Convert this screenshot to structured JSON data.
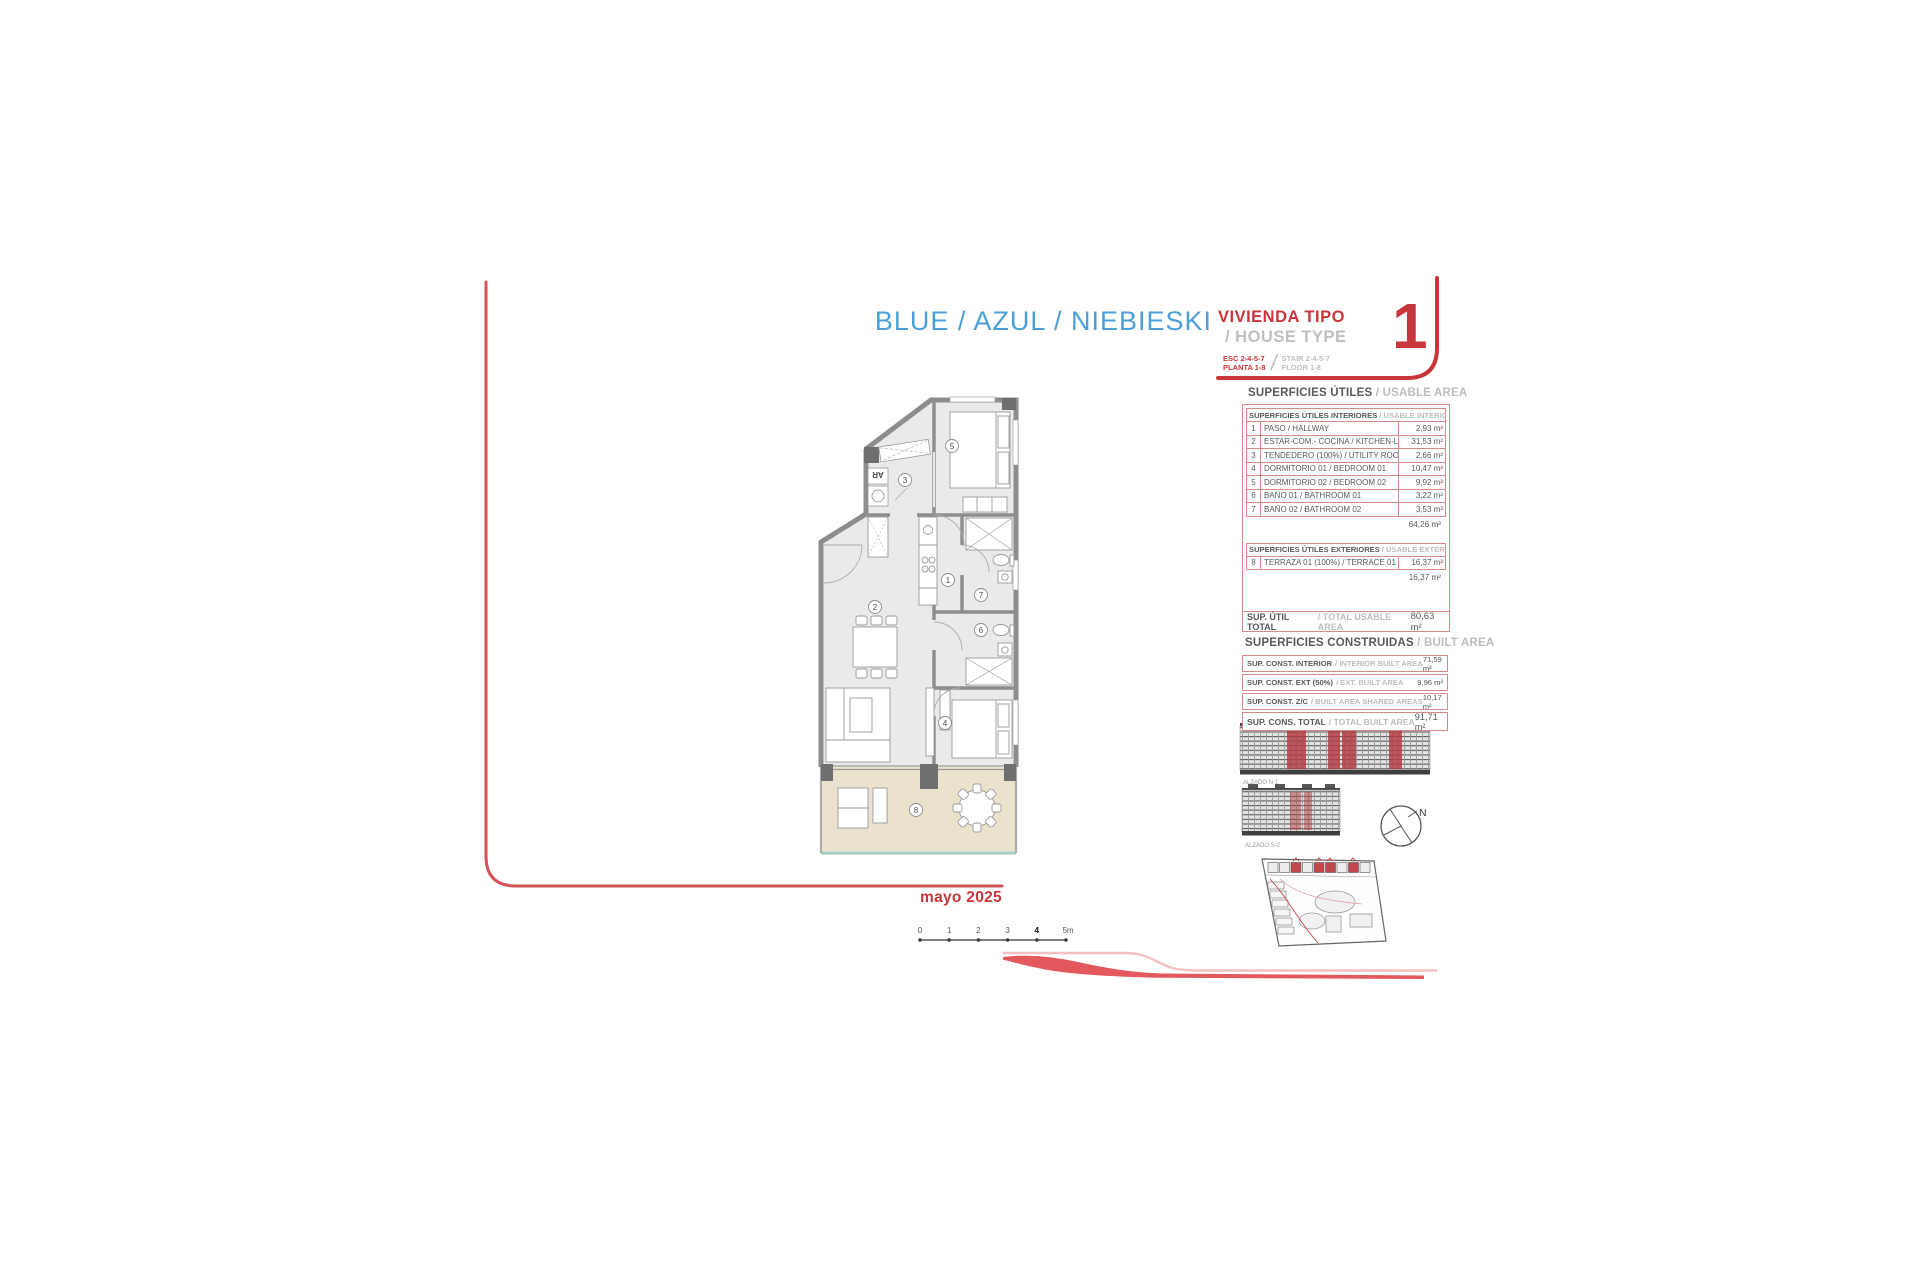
{
  "title": {
    "names": "BLUE / AZUL / NIEBIESKI",
    "vivienda": "VIVIENDA TIPO",
    "house_type": "/ HOUSE TYPE",
    "esc": "ESC 2-4-5-7",
    "planta": "PLANTA 1-8",
    "stair": "STAIR 2-4-5-7",
    "floor": "FLOOR 1-8",
    "number": "1"
  },
  "usable": {
    "heading_es": "SUPERFICIES ÚTILES",
    "heading_en": "/ USABLE AREA",
    "interior": {
      "header_es": "SUPERFICIES ÚTILES INTERIORES",
      "header_en": "/ USABLE INTERIOR AREA",
      "rows": [
        {
          "num": "1",
          "label": "PASO / HALLWAY",
          "value": "2,93 m²"
        },
        {
          "num": "2",
          "label": "ESTAR-COM.- COCINA / KITCHEN-LIVING",
          "value": "31,53 m²"
        },
        {
          "num": "3",
          "label": "TENDEDERO (100%) / UTILITY ROOM",
          "value": "2,66 m²"
        },
        {
          "num": "4",
          "label": "DORMITORIO 01 / BEDROOM 01",
          "value": "10,47 m²"
        },
        {
          "num": "5",
          "label": "DORMITORIO 02 / BEDROOM 02",
          "value": "9,92 m²"
        },
        {
          "num": "6",
          "label": "BAÑO 01 / BATHROOM 01",
          "value": "3,22 m²"
        },
        {
          "num": "7",
          "label": "BAÑO 02 / BATHROOM 02",
          "value": "3,53 m²"
        }
      ],
      "subtotal": "64,26 m²"
    },
    "exterior": {
      "header_es": "SUPERFICIES ÚTILES EXTERIORES",
      "header_en": "/ USABLE EXTERIOR AREA",
      "rows": [
        {
          "num": "8",
          "label": "TERRAZA 01 (100%) / TERRACE 01",
          "value": "16,37 m²"
        }
      ],
      "subtotal": "16,37 m²"
    },
    "total_es": "SUP. ÚTIL TOTAL",
    "total_en": "/ TOTAL USABLE AREA",
    "total_value": "80,63 m²"
  },
  "built": {
    "heading_es": "SUPERFICIES CONSTRUIDAS",
    "heading_en": "/ BUILT AREA",
    "rows": [
      {
        "label_es": "SUP. CONST. INTERIOR",
        "label_en": "/ INTERIOR BUILT AREA",
        "value": "71,59 m²"
      },
      {
        "label_es": "SUP. CONST. EXT (50%)",
        "label_en": "/ EXT. BUILT AREA",
        "value": "9,96 m²"
      },
      {
        "label_es": "SUP. CONST. Z/C",
        "label_en": "/ BUILT AREA SHARED AREAS",
        "value": "10,17 m²"
      },
      {
        "label_es": "SUP. CONS. TOTAL",
        "label_en": "/ TOTAL BUILT AREA",
        "value": "91,71 m²"
      }
    ]
  },
  "elevations": [
    {
      "label": "ALZADO N-1"
    },
    {
      "label": "ALZADO S-2"
    }
  ],
  "compass": {
    "n": "N"
  },
  "scale": {
    "ticks": [
      "0",
      "1",
      "2",
      "3",
      "4",
      "5m"
    ]
  },
  "footer": {
    "date": "mayo 2025"
  },
  "plan": {
    "rooms": [
      "1",
      "2",
      "3",
      "4",
      "5",
      "6",
      "7",
      "8"
    ],
    "utility_label": "AR"
  },
  "colors": {
    "accent_blue": "#4D9FD7",
    "accent_red": "#C8353B",
    "frame_red": "#D2545A",
    "table_border": "#D9898D",
    "wall_gray": "#8D8D8D",
    "terrace_beige": "#EAE2CC",
    "glass_teal": "#9FD0CB"
  }
}
